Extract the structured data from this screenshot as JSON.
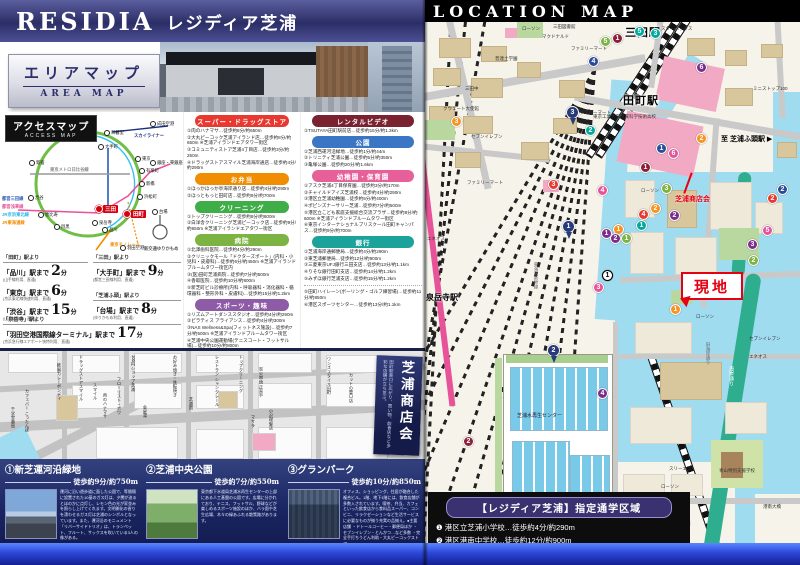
{
  "palette": {
    "brand_navy": "#34376f",
    "banner_black": "#000000",
    "map_water": "#9fdcf0",
    "map_building_tan": "#d8c69c",
    "map_pink": "#f2a9c4",
    "map_green_road": "#2fae8f",
    "genchi_red": "#e60012",
    "spots_bg": "#1a2562",
    "band_blue": "#2b46d9"
  },
  "header": {
    "logo_en": "RESIDIA",
    "logo_jp": "レジディア芝浦"
  },
  "area_map": {
    "jp": "エリアマップ",
    "en": "AREA MAP"
  },
  "access": {
    "label_jp": "アクセスマップ",
    "label_en": "ACCESS MAP",
    "stations": [
      {
        "t": "池袋",
        "x": 52,
        "y": 22
      },
      {
        "t": "新宿",
        "x": 31,
        "y": 50
      },
      {
        "t": "渋谷",
        "x": 30,
        "y": 85
      },
      {
        "t": "恵比寿",
        "x": 40,
        "y": 102
      },
      {
        "t": "目黒",
        "x": 56,
        "y": 114
      },
      {
        "t": "品川",
        "x": 104,
        "y": 117
      },
      {
        "t": "日暮里",
        "x": 106,
        "y": 20
      },
      {
        "t": "成田空港",
        "x": 152,
        "y": 11
      },
      {
        "t": "大手町",
        "x": 100,
        "y": 34
      },
      {
        "t": "東京",
        "x": 137,
        "y": 46
      },
      {
        "t": "有楽町",
        "x": 141,
        "y": 58
      },
      {
        "t": "銀座・東銀座",
        "x": 152,
        "y": 50
      },
      {
        "t": "新橋",
        "x": 141,
        "y": 71
      },
      {
        "t": "浜松町",
        "x": 139,
        "y": 84
      },
      {
        "t": "田町",
        "x": 126,
        "y": 100,
        "red": 1
      },
      {
        "t": "三田",
        "x": 98,
        "y": 95,
        "red": 1
      },
      {
        "t": "泉岳寺",
        "x": 94,
        "y": 110
      },
      {
        "t": "羽田空港",
        "x": 122,
        "y": 135
      },
      {
        "t": "台場",
        "x": 154,
        "y": 99
      }
    ],
    "lines": [
      {
        "t": "JR山手線",
        "x": 62,
        "y": 6,
        "c": "#4aa832"
      },
      {
        "t": "スカイライナー",
        "x": 134,
        "y": 21,
        "c": "#1b2f7e"
      },
      {
        "t": "東京メトロ日比谷線",
        "x": 50,
        "y": 55,
        "c": "#8a8a8a"
      },
      {
        "t": "都営三田線",
        "x": 2,
        "y": 84,
        "c": "#2b5cb8"
      },
      {
        "t": "都営浅草線",
        "x": 2,
        "y": 92,
        "c": "#e85298"
      },
      {
        "t": "JR京浜東北線",
        "x": 2,
        "y": 100,
        "c": "#29b6e8"
      },
      {
        "t": "JR東海道線",
        "x": 2,
        "y": 108,
        "c": "#f18d00"
      },
      {
        "t": "東京モノレール",
        "x": 110,
        "y": 130,
        "c": "#f18d00"
      },
      {
        "t": "新交通ゆりかもめ",
        "x": 144,
        "y": 134,
        "c": "#555555"
      }
    ]
  },
  "routes": [
    {
      "from": "「田町」駅より",
      "items": [
        {
          "dest": "「品川」駅まで",
          "min": "2",
          "unit": "分",
          "note": "(山手線利用、直通)"
        },
        {
          "dest": "「東京」駅まで",
          "min": "6",
          "unit": "分",
          "note": "(京浜東北線快速利用、直通)"
        },
        {
          "dest": "「渋谷」駅まで",
          "min": "15",
          "unit": "分",
          "note": "(山手線利用、直通)"
        }
      ]
    },
    {
      "from": "「三田」駅より",
      "items": [
        {
          "dest": "「大手町」駅まで",
          "min": "9",
          "unit": "分",
          "note": "(都営三田線利用、直通)"
        }
      ]
    },
    {
      "from": "「芝浦ふ頭」駅より",
      "items": [
        {
          "dest": "「台場」駅まで",
          "min": "8",
          "unit": "分",
          "note": "(ゆりかもめ利用、直通)"
        }
      ]
    },
    {
      "from": "「泉岳寺」駅より",
      "items": [
        {
          "dest": "「羽田空港国際線ターミナル」駅まで",
          "min": "17",
          "unit": "分",
          "note": "(京浜急行線エアポート快特利用、直通)"
        }
      ]
    }
  ],
  "facilities": {
    "left": [
      {
        "title": "スーパー・ドラッグストア",
        "items": [
          "①肉のハナマサ…徒歩約8分/約650m",
          "②大丸ピーコック芝浦アイランド店…徒歩約8分/約650m ※芝浦アイランドエアタワー街区",
          "③コミュニティストア芝浦4丁目店…徒歩約3分/約250m",
          "④ドラッグストアスマイル芝浦海岸通店…徒歩約4分/約290m"
        ]
      },
      {
        "title": "お弁当",
        "items": [
          "①ほっかほっか亭海岸通り店…徒歩約4分/約290m",
          "②ほっともっと田町店…徒歩約9分/約700m"
        ]
      },
      {
        "title": "クリーニング",
        "items": [
          "①トップクリーニング…徒歩約8分/約600m",
          "②白洋舎クリーニング芝浦ピーコック店…徒歩約9分/約650m ※芝浦アイランドエアタワー街区"
        ]
      },
      {
        "title": "病院",
        "items": [
          "①北澤歯科医院…徒歩約4分/約290m",
          "②クリニックモール「ドクターズポート」(内科・小児科・皮膚科)…徒歩約6分/約450m ※芝浦アイランドブルームタワー街区内",
          "③(医)田町芝浦病院…徒歩約7分/約500m",
          "④香取医院…徒歩約10分/約800m",
          "⑤新芝町ビル診療所(内科・呼吸器科・消化器科・循環器科・整形外科・皮膚科)…徒歩約15分/約1.2km"
        ]
      },
      {
        "title": "スポーツ・趣味",
        "items": [
          "①リズムアートダンススタジオ…徒歩約4分/約290m",
          "②ピラティス アライアンス…徒歩約4分/約300m",
          "③NAS Wellness&Spa(フィットネス施設)…徒歩約7分/約500m ※芝浦アイランドブルームタワー街区",
          "④芝浦中央公園運動場(テニスコート・フットサル場)…徒歩約10分/約800m"
        ]
      }
    ],
    "right": [
      {
        "title": "レンタルビデオ",
        "items": [
          "①TSUTAYA田町駅前店…徒歩約15分/約1.3km"
        ]
      },
      {
        "title": "公園",
        "items": [
          "①芝浦西運河沿緑地…徒歩約1分/約44m",
          "②トリニティ芝浦公園…徒歩約5分/約350m",
          "③亀塚公園…徒歩約20分/約1.6km"
        ]
      },
      {
        "title": "幼稚園・保育園",
        "items": [
          "①アスク芝浦4丁目保育園…徒歩約3分/約170m",
          "②チャイルドアイズ芝浦校…徒歩約4分/約290m",
          "③港区立芝浦幼稚園…徒歩約5分/約400m",
          "④ポピンズナーサリー芝浦…徒歩約7分/約500m",
          "⑤港区立こども家庭支援総合交流プラザ…徒歩約8分/約600m ※芝浦アイランドブルームタワー街区",
          "⑥東京インターナショナルプリスクール田町キャンパス…徒歩約9分/約700m"
        ]
      },
      {
        "title": "銀行",
        "items": [
          "①芝浦海岸通郵便局…徒歩約4分/約290m",
          "②東芝浦郵便局…徒歩約12分/約900m",
          "③三菱東京UFJ銀行三田支店…徒歩約13分/約1.1km",
          "④りそな銀行田町支店…徒歩約14分/約1.2km",
          "⑤みずほ銀行芝浦支店…徒歩約15分/約1.2km"
        ]
      }
    ],
    "overflow": [
      "⑤田町ハイレーン(ボーリング・ゴルフ練習場)…徒歩約11分/約850m",
      "⑥港区スポーツセンター…徒歩約13分/約1.1km"
    ]
  },
  "shopmap": {
    "banner_title": "芝浦商店会",
    "banner_sub": "田町駅東口に広がり、買い物、飲食店など多彩な店舗が立ち並ぶ。",
    "labels": [
      {
        "t": "カフェバー こったんぽ",
        "x": 24,
        "y": 38
      },
      {
        "t": "千学堂薬局",
        "x": 10,
        "y": 56
      },
      {
        "t": "欧風カレーボンディ",
        "x": 56,
        "y": 12
      },
      {
        "t": "ドラッグストアスマイル",
        "x": 78,
        "y": 4
      },
      {
        "t": "スマイル",
        "x": 92,
        "y": 32
      },
      {
        "t": "肉のハナマサ",
        "x": 102,
        "y": 42
      },
      {
        "t": "フローリスト・ボワ",
        "x": 116,
        "y": 26
      },
      {
        "t": "100円ショップ芝浦",
        "x": 130,
        "y": 4
      },
      {
        "t": "金星湯",
        "x": 142,
        "y": 54
      },
      {
        "t": "お好み焼き・鉄板焼き",
        "x": 172,
        "y": 4
      },
      {
        "t": "芝浦園",
        "x": 188,
        "y": 46
      },
      {
        "t": "レストラン シャンクレール",
        "x": 214,
        "y": 4
      },
      {
        "t": "トップクリーニング",
        "x": 238,
        "y": 4
      },
      {
        "t": "炭火串焼 正直や",
        "x": 258,
        "y": 16
      },
      {
        "t": "マサラ",
        "x": 250,
        "y": 64
      },
      {
        "t": "小沢理髪店",
        "x": 268,
        "y": 58
      },
      {
        "t": "ワンズスタイル田町",
        "x": 326,
        "y": 6
      },
      {
        "t": "カットの壹口店",
        "x": 348,
        "y": 22
      }
    ]
  },
  "spots": [
    {
      "num": "①",
      "name": "新芝運河沿緑地",
      "walk": "徒歩約9分/約750m",
      "desc": "運河に沿い遊歩道に面した公園で、等間隔に設置された10基のガス灯は、夕闇が迫るとほのかに点灯し、レモン色の光が家並みを照らし上げてくれます。文明開化の香りを漂わせるガス灯は芝浦のシンボルとなっています。また、運河沿のモニュメント「リバーサイドトリオ」は、トランペット、フルート、サックスを吹いている3人の像がある。"
    },
    {
      "num": "②",
      "name": "芝浦中央公園",
      "walk": "徒歩約7分/約550m",
      "desc": "東京都下水道局芝浦水再生センターの上部にある人工基盤の公園です。広場に分かれており、テニス、フットサル、野球などが楽しめるスポーツ施設のほか、バラ園や芝生広場、木々の緑あふれる散策路があります。"
    },
    {
      "num": "③",
      "name": "グランパーク",
      "walk": "徒歩約10分/約850m",
      "desc": "オフィス、ショッピング、住居が融合した複合ビル。1階、地下1階には、飲食店舗が多数入されています。喫茶、弁当、カフェといった飲食店から食料品スーパー、コンビニ、リラクゼーションなど生活サービスに必要なものが揃う充実の品揃え。●主要店舗 ・ドトールコーヒー・郵便局ほか ・セブンイレブン・とんかつ…など多数 ・完全手打ちうどん利助・大丸ピーコックストア"
    }
  ],
  "locmap": {
    "title": "LOCATION MAP",
    "genchi": "現地",
    "labels": [
      {
        "t": "三田駅",
        "x": 200,
        "y": 2,
        "k": "sta"
      },
      {
        "t": "田町駅",
        "x": 198,
        "y": 70,
        "k": "sta"
      },
      {
        "t": "泉岳寺駅",
        "x": 1,
        "y": 270,
        "k": "sta2"
      },
      {
        "t": "至 芝浦ふ頭駅 ▶",
        "x": 296,
        "y": 112,
        "k": "dir"
      },
      {
        "t": "芝浦商店会",
        "x": 250,
        "y": 172,
        "k": "red"
      },
      {
        "t": "ローソン",
        "x": 97,
        "y": 4
      },
      {
        "t": "三田図書館",
        "x": 128,
        "y": 2
      },
      {
        "t": "マクドナルド",
        "x": 117,
        "y": 12
      },
      {
        "t": "スターバックス",
        "x": 236,
        "y": 4
      },
      {
        "t": "ファミリーマート",
        "x": 146,
        "y": 24
      },
      {
        "t": "普連土学園",
        "x": 70,
        "y": 34
      },
      {
        "t": "三田中",
        "x": 40,
        "y": 64
      },
      {
        "t": "クウェート大使館",
        "x": 18,
        "y": 84
      },
      {
        "t": "ファミリーマート",
        "x": 150,
        "y": 88
      },
      {
        "t": "東京工業大学附属科学技術高校",
        "x": 168,
        "y": 92
      },
      {
        "t": "セブンイレブン",
        "x": 46,
        "y": 112
      },
      {
        "t": "ファミリーマート",
        "x": 42,
        "y": 158
      },
      {
        "t": "ミニストップ100",
        "x": 328,
        "y": 64
      },
      {
        "t": "ローソン",
        "x": 216,
        "y": 166
      },
      {
        "t": "エネオス",
        "x": 2,
        "y": 214
      },
      {
        "t": "ローソン",
        "x": 271,
        "y": 292
      },
      {
        "t": "セブンイレブン",
        "x": 324,
        "y": 314
      },
      {
        "t": "エネオス",
        "x": 324,
        "y": 332
      },
      {
        "t": "ローソン",
        "x": 236,
        "y": 462
      },
      {
        "t": "スリーエフ",
        "x": 244,
        "y": 444
      },
      {
        "t": "芝浦水再生センター",
        "x": 92,
        "y": 390,
        "k": "wlab"
      },
      {
        "t": "青山特別支援学校",
        "x": 294,
        "y": 446
      },
      {
        "t": "港南大橋",
        "x": 338,
        "y": 482
      },
      {
        "t": "旧海岸通り",
        "x": 280,
        "y": 320,
        "k": "vg"
      },
      {
        "t": "東海道新幹線",
        "x": 108,
        "y": 240,
        "k": "vg"
      },
      {
        "t": "海岸通り",
        "x": 303,
        "y": 344,
        "k": "vw"
      }
    ],
    "badges": [
      {
        "n": "5",
        "c": "green",
        "x": 175,
        "y": 14
      },
      {
        "n": "1",
        "c": "maroon",
        "x": 187,
        "y": 11
      },
      {
        "n": "5",
        "c": "teal",
        "x": 209,
        "y": 4
      },
      {
        "n": "3",
        "c": "teal",
        "x": 225,
        "y": 6
      },
      {
        "n": "4",
        "c": "blue",
        "x": 163,
        "y": 34
      },
      {
        "n": "6",
        "c": "purple",
        "x": 271,
        "y": 40
      },
      {
        "n": "3",
        "c": "orange",
        "x": 26,
        "y": 94
      },
      {
        "n": "3",
        "c": "navy",
        "x": 141,
        "y": 84,
        "p": 1
      },
      {
        "n": "2",
        "c": "teal",
        "x": 160,
        "y": 103
      },
      {
        "n": "2",
        "c": "orange",
        "x": 271,
        "y": 111
      },
      {
        "n": "3",
        "c": "red",
        "x": 123,
        "y": 157
      },
      {
        "n": "1",
        "c": "blue",
        "x": 231,
        "y": 121
      },
      {
        "n": "6",
        "c": "pink",
        "x": 243,
        "y": 126
      },
      {
        "n": "1",
        "c": "maroon",
        "x": 215,
        "y": 140
      },
      {
        "n": "4",
        "c": "pink",
        "x": 172,
        "y": 163
      },
      {
        "n": "3",
        "c": "green",
        "x": 236,
        "y": 161
      },
      {
        "n": "2",
        "c": "orange",
        "x": 225,
        "y": 181
      },
      {
        "n": "2",
        "c": "purple",
        "x": 244,
        "y": 188
      },
      {
        "n": "4",
        "c": "red",
        "x": 213,
        "y": 187
      },
      {
        "n": "1",
        "c": "teal",
        "x": 211,
        "y": 198
      },
      {
        "n": "1",
        "c": "purple",
        "x": 176,
        "y": 206
      },
      {
        "n": "1",
        "c": "orange",
        "x": 188,
        "y": 202
      },
      {
        "n": "2",
        "c": "purple",
        "x": 185,
        "y": 211
      },
      {
        "n": "1",
        "c": "green",
        "x": 196,
        "y": 211
      },
      {
        "n": "2",
        "c": "blue",
        "x": 352,
        "y": 162
      },
      {
        "n": "2",
        "c": "red",
        "x": 342,
        "y": 171
      },
      {
        "n": "5",
        "c": "pink",
        "x": 337,
        "y": 203
      },
      {
        "n": "3",
        "c": "purple",
        "x": 322,
        "y": 217
      },
      {
        "n": "2",
        "c": "green",
        "x": 323,
        "y": 233
      },
      {
        "n": "1",
        "c": "white",
        "x": 177,
        "y": 248
      },
      {
        "n": "3",
        "c": "pink",
        "x": 168,
        "y": 260
      },
      {
        "n": "1",
        "c": "orange",
        "x": 245,
        "y": 282
      },
      {
        "n": "1",
        "c": "navy",
        "x": 137,
        "y": 198,
        "p": 1
      },
      {
        "n": "2",
        "c": "navy",
        "x": 122,
        "y": 322,
        "p": 1
      },
      {
        "n": "4",
        "c": "purple",
        "x": 172,
        "y": 366
      },
      {
        "n": "2",
        "c": "green",
        "x": 254,
        "y": 496
      },
      {
        "n": "2",
        "c": "maroon",
        "x": 38,
        "y": 414
      }
    ]
  },
  "school": {
    "title": "【レジディア芝浦】指定通学区域",
    "items": [
      "❶ 港区立芝浦小学校…徒歩約4分/約290m",
      "❷ 港区港南中学校…徒歩約12分/約900m"
    ]
  }
}
